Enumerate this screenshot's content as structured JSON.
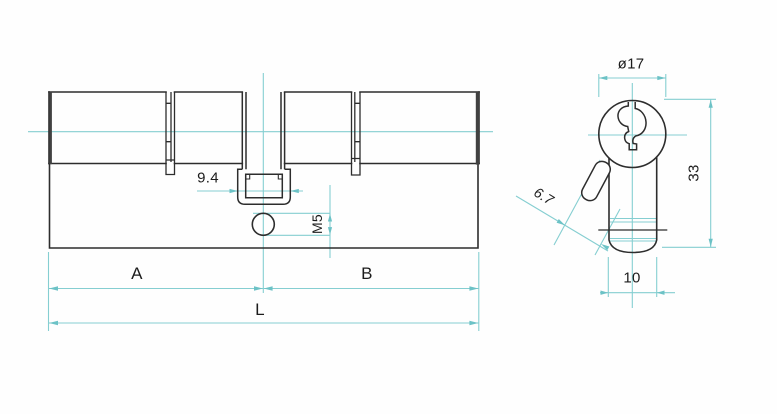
{
  "drawing": {
    "type": "technical-drawing",
    "subject": "euro profile lock cylinder",
    "colors": {
      "outline": "#2d2d2d",
      "dimension_line": "#85ced1",
      "label_text": "#1c1c1c",
      "background": "#ffffff"
    },
    "side_view": {
      "dimensions": {
        "cam_width": "9.4",
        "screw_thread": "M5",
        "length_a": "A",
        "length_b": "B",
        "total_length": "L"
      }
    },
    "front_view": {
      "dimensions": {
        "plug_diameter": "ø17",
        "cam_protrusion": "6.7",
        "body_height": "33",
        "body_width": "10"
      }
    }
  }
}
